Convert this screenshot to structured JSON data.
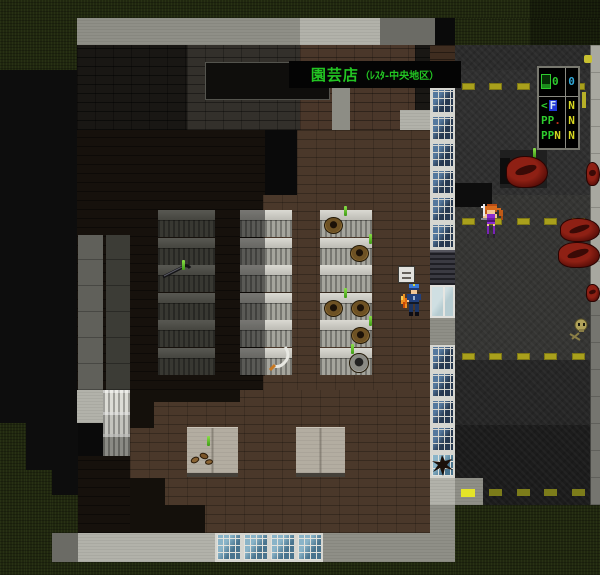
{
  "scene": {
    "name": "garden-shop-night-street",
    "banner": {
      "shop_name": "園芸店",
      "area_suffix": "（ﾚｽﾀ-中央地区）"
    },
    "hud": {
      "row1": {
        "left_value": "0",
        "right_value": "0"
      },
      "row2": {
        "cursor": "<",
        "selected": "F",
        "right_value": "N"
      },
      "row3": {
        "left_value": "PP",
        "dot": ".",
        "right_value": "N"
      },
      "row4": {
        "left_value": "PP",
        "suffix": "N",
        "right_value": "N"
      }
    },
    "colors": {
      "green": "#2ecc2e",
      "cyan": "#30a8d8",
      "yellow": "#d8d820",
      "blue": "#2238d8",
      "red": "#c03018",
      "banner_green": "#23c523",
      "dash": "#a9a01c",
      "dash_dim": "#7c7c1a"
    },
    "entities": {
      "player": "sword-girl-purple-outfit",
      "npc": "police-officer-with-flame",
      "corpse_count": 5,
      "props": [
        "crowbar",
        "sickle",
        "flower-pots",
        "bucket",
        "seeds",
        "sprouts",
        "skull-remains",
        "placard",
        "broken-window"
      ]
    }
  }
}
